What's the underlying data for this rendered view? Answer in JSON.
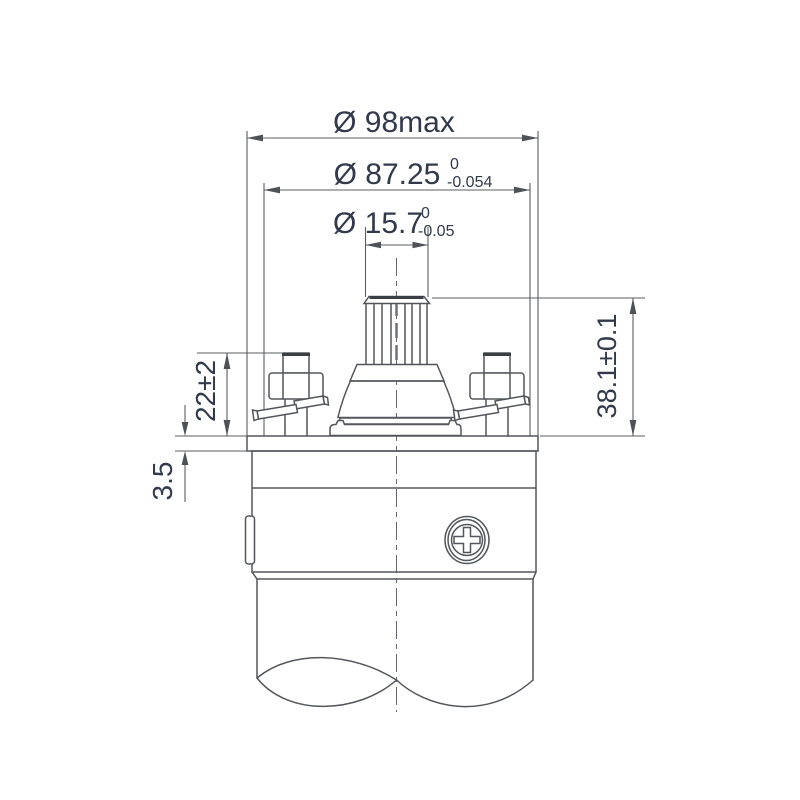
{
  "drawing": {
    "background_color": "#ffffff",
    "line_color": "#53565b",
    "text_color": "#31394a",
    "dimensions": {
      "outer_diameter": {
        "label": "Ø 98max"
      },
      "flange_diameter": {
        "label": "Ø 87.25",
        "tol_upper": "0",
        "tol_lower": "-0.054"
      },
      "shaft_diameter": {
        "label": "Ø 15.7",
        "tol_upper": "0",
        "tol_lower": "-0.05"
      },
      "shaft_height": {
        "label": "38.1±0.1"
      },
      "terminal_height": {
        "label": "22±2"
      },
      "flange_thickness": {
        "label": "3.5"
      }
    }
  }
}
